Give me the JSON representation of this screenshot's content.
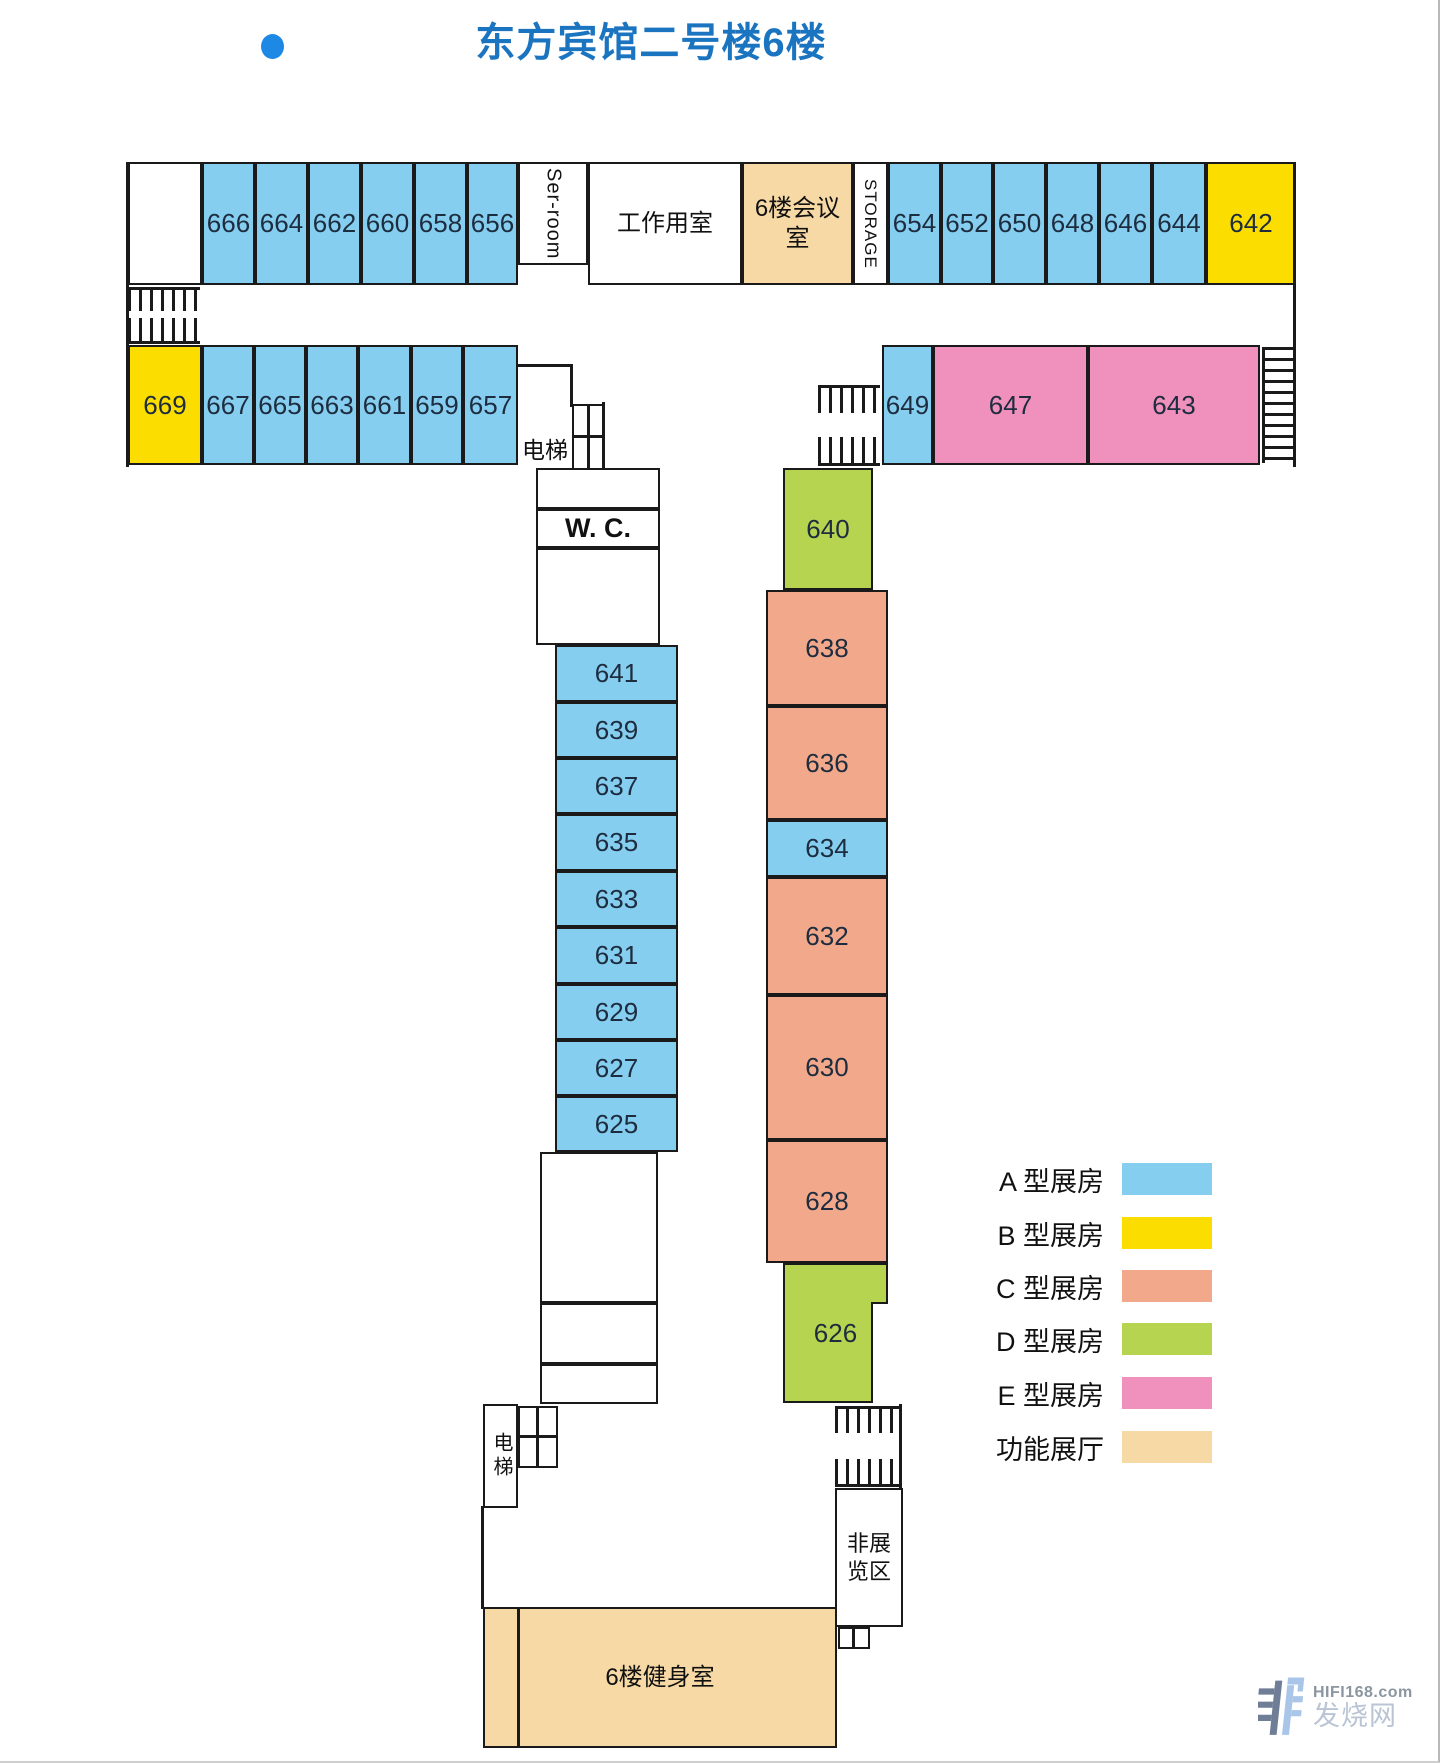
{
  "title": "东方宾馆二号楼6楼",
  "colors": {
    "A": "#85CEF0",
    "B": "#FBDE00",
    "C": "#F2A98B",
    "D": "#B6D44F",
    "E": "#F090BC",
    "F": "#F7D9A5",
    "W": "#FFFFFF",
    "wall": "#1a1a1a",
    "title": "#1B74C0",
    "number": "#1D2C3E",
    "dot": "#1E88E5"
  },
  "legend": {
    "items": [
      {
        "label": "A 型展房",
        "fill": "A",
        "y": 1157
      },
      {
        "label": "B 型展房",
        "fill": "B",
        "y": 1211
      },
      {
        "label": "C 型展房",
        "fill": "C",
        "y": 1264
      },
      {
        "label": "D 型展房",
        "fill": "D",
        "y": 1317
      },
      {
        "label": "E 型展房",
        "fill": "E",
        "y": 1371
      },
      {
        "label": "功能展厅",
        "fill": "F",
        "y": 1425
      }
    ]
  },
  "watermark": {
    "site": "HIFI168.com",
    "name": "发烧网"
  },
  "plan": {
    "rooms": [
      {
        "name": "room-top-blank",
        "label": "",
        "x": 128,
        "y": 162,
        "w": 74,
        "h": 123,
        "fill": "W"
      },
      {
        "label": "666",
        "x": 202,
        "y": 162,
        "w": 53,
        "h": 123,
        "fill": "A"
      },
      {
        "label": "664",
        "x": 255,
        "y": 162,
        "w": 53,
        "h": 123,
        "fill": "A"
      },
      {
        "label": "662",
        "x": 308,
        "y": 162,
        "w": 53,
        "h": 123,
        "fill": "A"
      },
      {
        "label": "660",
        "x": 361,
        "y": 162,
        "w": 53,
        "h": 123,
        "fill": "A"
      },
      {
        "label": "658",
        "x": 414,
        "y": 162,
        "w": 53,
        "h": 123,
        "fill": "A"
      },
      {
        "label": "656",
        "x": 467,
        "y": 162,
        "w": 51,
        "h": 123,
        "fill": "A"
      },
      {
        "name": "room-ser-room",
        "label": "Ser-room",
        "x": 518,
        "y": 162,
        "w": 70,
        "h": 103,
        "fill": "W",
        "size": 20,
        "vert": true,
        "cn": true
      },
      {
        "name": "room-work-room",
        "label": "工作用室",
        "x": 588,
        "y": 162,
        "w": 154,
        "h": 123,
        "fill": "W",
        "size": 24,
        "cn": true
      },
      {
        "name": "room-meeting-room",
        "label": "6楼会议室",
        "x": 742,
        "y": 162,
        "w": 111,
        "h": 123,
        "fill": "F",
        "size": 24,
        "cn": true
      },
      {
        "name": "room-storage",
        "label": "STORAGE",
        "x": 853,
        "y": 162,
        "w": 35,
        "h": 123,
        "fill": "W",
        "size": 17,
        "vert": true,
        "cn": true
      },
      {
        "label": "654",
        "x": 888,
        "y": 162,
        "w": 53,
        "h": 123,
        "fill": "A"
      },
      {
        "label": "652",
        "x": 941,
        "y": 162,
        "w": 52,
        "h": 123,
        "fill": "A"
      },
      {
        "label": "650",
        "x": 993,
        "y": 162,
        "w": 53,
        "h": 123,
        "fill": "A"
      },
      {
        "label": "648",
        "x": 1046,
        "y": 162,
        "w": 53,
        "h": 123,
        "fill": "A"
      },
      {
        "label": "646",
        "x": 1099,
        "y": 162,
        "w": 53,
        "h": 123,
        "fill": "A"
      },
      {
        "label": "644",
        "x": 1152,
        "y": 162,
        "w": 54,
        "h": 123,
        "fill": "A"
      },
      {
        "label": "642",
        "x": 1206,
        "y": 162,
        "w": 90,
        "h": 123,
        "fill": "B"
      },
      {
        "label": "669",
        "x": 128,
        "y": 345,
        "w": 74,
        "h": 120,
        "fill": "B"
      },
      {
        "label": "667",
        "x": 202,
        "y": 345,
        "w": 52,
        "h": 120,
        "fill": "A"
      },
      {
        "label": "665",
        "x": 254,
        "y": 345,
        "w": 52,
        "h": 120,
        "fill": "A"
      },
      {
        "label": "663",
        "x": 306,
        "y": 345,
        "w": 52,
        "h": 120,
        "fill": "A"
      },
      {
        "label": "661",
        "x": 358,
        "y": 345,
        "w": 53,
        "h": 120,
        "fill": "A"
      },
      {
        "label": "659",
        "x": 411,
        "y": 345,
        "w": 52,
        "h": 120,
        "fill": "A"
      },
      {
        "label": "657",
        "x": 463,
        "y": 345,
        "w": 55,
        "h": 120,
        "fill": "A"
      },
      {
        "label": "649",
        "x": 882,
        "y": 345,
        "w": 51,
        "h": 120,
        "fill": "A"
      },
      {
        "label": "647",
        "x": 933,
        "y": 345,
        "w": 155,
        "h": 120,
        "fill": "E"
      },
      {
        "label": "643",
        "x": 1088,
        "y": 345,
        "w": 172,
        "h": 120,
        "fill": "E"
      },
      {
        "label": "640",
        "x": 783,
        "y": 468,
        "w": 90,
        "h": 122,
        "fill": "D"
      },
      {
        "label": "638",
        "x": 766,
        "y": 590,
        "w": 122,
        "h": 116,
        "fill": "C"
      },
      {
        "label": "636",
        "x": 766,
        "y": 706,
        "w": 122,
        "h": 114,
        "fill": "C"
      },
      {
        "label": "634",
        "x": 766,
        "y": 820,
        "w": 122,
        "h": 57,
        "fill": "A"
      },
      {
        "label": "632",
        "x": 766,
        "y": 877,
        "w": 122,
        "h": 118,
        "fill": "C"
      },
      {
        "label": "630",
        "x": 766,
        "y": 995,
        "w": 122,
        "h": 145,
        "fill": "C"
      },
      {
        "label": "628",
        "x": 766,
        "y": 1140,
        "w": 122,
        "h": 123,
        "fill": "C"
      },
      {
        "label": "626",
        "x": 783,
        "y": 1263,
        "w": 105,
        "h": 140,
        "fill": "D"
      },
      {
        "label": "641",
        "x": 555,
        "y": 645,
        "w": 123,
        "h": 57,
        "fill": "A"
      },
      {
        "label": "639",
        "x": 555,
        "y": 702,
        "w": 123,
        "h": 56,
        "fill": "A"
      },
      {
        "label": "637",
        "x": 555,
        "y": 758,
        "w": 123,
        "h": 56,
        "fill": "A"
      },
      {
        "label": "635",
        "x": 555,
        "y": 814,
        "w": 123,
        "h": 57,
        "fill": "A"
      },
      {
        "label": "633",
        "x": 555,
        "y": 871,
        "w": 123,
        "h": 56,
        "fill": "A"
      },
      {
        "label": "631",
        "x": 555,
        "y": 927,
        "w": 123,
        "h": 57,
        "fill": "A"
      },
      {
        "label": "629",
        "x": 555,
        "y": 984,
        "w": 123,
        "h": 56,
        "fill": "A"
      },
      {
        "label": "627",
        "x": 555,
        "y": 1040,
        "w": 123,
        "h": 56,
        "fill": "A"
      },
      {
        "label": "625",
        "x": 555,
        "y": 1096,
        "w": 123,
        "h": 56,
        "fill": "A"
      },
      {
        "name": "room-wc-upper",
        "label": "",
        "x": 536,
        "y": 468,
        "w": 124,
        "h": 41,
        "fill": "W"
      },
      {
        "name": "room-wc",
        "label": "W. C.",
        "x": 536,
        "y": 509,
        "w": 124,
        "h": 39,
        "fill": "W",
        "size": 27,
        "bold": true,
        "cn": true
      },
      {
        "name": "room-wc-lower",
        "label": "",
        "x": 536,
        "y": 548,
        "w": 124,
        "h": 97,
        "fill": "W"
      },
      {
        "name": "room-corridor-1",
        "label": "",
        "x": 540,
        "y": 1152,
        "w": 118,
        "h": 151,
        "fill": "W"
      },
      {
        "name": "room-corridor-2",
        "label": "",
        "x": 540,
        "y": 1303,
        "w": 118,
        "h": 61,
        "fill": "W"
      },
      {
        "name": "room-corridor-3",
        "label": "",
        "x": 540,
        "y": 1364,
        "w": 118,
        "h": 40,
        "fill": "W"
      },
      {
        "name": "room-elevator-bottom",
        "label": "电梯",
        "x": 483,
        "y": 1404,
        "w": 35,
        "h": 104,
        "fill": "W",
        "size": 20,
        "vcjk": true,
        "cn": true
      },
      {
        "name": "shaft-top-1",
        "label": "",
        "x": 572,
        "y": 404,
        "w": 17,
        "h": 33,
        "fill": "W"
      },
      {
        "name": "shaft-top-2",
        "label": "",
        "x": 588,
        "y": 404,
        "w": 17,
        "h": 33,
        "fill": "W"
      },
      {
        "name": "shaft-top-3",
        "label": "",
        "x": 572,
        "y": 436,
        "w": 17,
        "h": 34,
        "fill": "W"
      },
      {
        "name": "shaft-top-4",
        "label": "",
        "x": 588,
        "y": 436,
        "w": 17,
        "h": 34,
        "fill": "W"
      },
      {
        "name": "shaft-bottom-1",
        "label": "",
        "x": 518,
        "y": 1406,
        "w": 20,
        "h": 31,
        "fill": "W"
      },
      {
        "name": "shaft-bottom-2",
        "label": "",
        "x": 537,
        "y": 1406,
        "w": 21,
        "h": 31,
        "fill": "W"
      },
      {
        "name": "shaft-bottom-3",
        "label": "",
        "x": 518,
        "y": 1436,
        "w": 20,
        "h": 32,
        "fill": "W"
      },
      {
        "name": "shaft-bottom-4",
        "label": "",
        "x": 537,
        "y": 1436,
        "w": 21,
        "h": 32,
        "fill": "W"
      },
      {
        "name": "room-non-exhibit",
        "label": "非展览区",
        "x": 835,
        "y": 1488,
        "w": 68,
        "h": 139,
        "fill": "W",
        "size": 22,
        "cn": true
      },
      {
        "name": "room-gym",
        "label": "6楼健身室",
        "x": 483,
        "y": 1607,
        "w": 354,
        "h": 141,
        "fill": "F",
        "size": 24,
        "cn": true
      },
      {
        "name": "shaft-gym-1",
        "label": "",
        "x": 838,
        "y": 1627,
        "w": 16,
        "h": 22,
        "fill": "W"
      },
      {
        "name": "shaft-gym-2",
        "label": "",
        "x": 853,
        "y": 1627,
        "w": 17,
        "h": 22,
        "fill": "W"
      }
    ],
    "floating_labels": [
      {
        "name": "label-elevator-top",
        "text": "电梯",
        "x": 512,
        "y": 432,
        "w": 66,
        "h": 32,
        "size": 23
      }
    ],
    "walls": [
      {
        "x": 126,
        "y": 162,
        "w": 3,
        "h": 305
      },
      {
        "x": 1293,
        "y": 162,
        "w": 3,
        "h": 305
      },
      {
        "x": 518,
        "y": 364,
        "w": 55,
        "h": 3
      },
      {
        "x": 570,
        "y": 364,
        "w": 3,
        "h": 43
      },
      {
        "x": 602,
        "y": 402,
        "w": 3,
        "h": 68
      },
      {
        "x": 481,
        "y": 1506,
        "w": 3,
        "h": 103
      },
      {
        "x": 899,
        "y": 1404,
        "w": 3,
        "h": 86
      },
      {
        "x": 517,
        "y": 1609,
        "w": 3,
        "h": 137
      }
    ],
    "hatches": [
      {
        "x": 128,
        "y": 287,
        "w": 72,
        "h": 24,
        "dir": "v",
        "edge": "top"
      },
      {
        "x": 128,
        "y": 318,
        "w": 72,
        "h": 26,
        "dir": "v",
        "edge": "bottom"
      },
      {
        "x": 818,
        "y": 385,
        "w": 62,
        "h": 28,
        "dir": "v",
        "edge": "top"
      },
      {
        "x": 818,
        "y": 437,
        "w": 62,
        "h": 29,
        "dir": "v",
        "edge": "bottom"
      },
      {
        "x": 1262,
        "y": 347,
        "w": 33,
        "h": 116,
        "dir": "h",
        "edge": "left"
      },
      {
        "x": 835,
        "y": 1406,
        "w": 64,
        "h": 27,
        "dir": "v",
        "edge": "top"
      },
      {
        "x": 835,
        "y": 1459,
        "w": 64,
        "h": 28,
        "dir": "v",
        "edge": "bottom"
      }
    ],
    "patches": [
      {
        "name": "notch-626",
        "x": 871,
        "y": 1302,
        "w": 17,
        "h": 101,
        "borders": [
          "left",
          "top"
        ]
      }
    ]
  }
}
